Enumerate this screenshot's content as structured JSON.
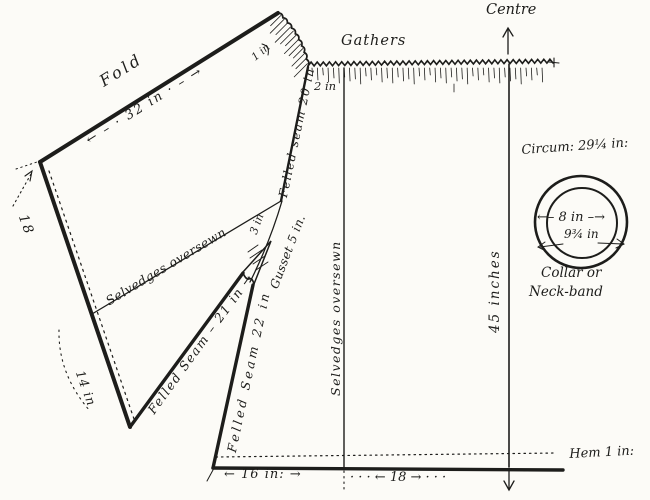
{
  "paper_color": "#fcfbf7",
  "ink_color": "#1d1d1b",
  "sleeve": {
    "fold_label": "Fold",
    "fold_dimension": "← – · 32 in · – →",
    "edge_upper_dimension": "18",
    "edge_lower_dimension": "14 in",
    "selvedge_label": "Selvedges oversewn",
    "seam_label": "Felled Seam – 21 in →",
    "ruffle_dimension": "1 in"
  },
  "body": {
    "gathers_label": "Gathers",
    "centre_label": "Centre",
    "shoulder_seam_label": "Felled seam 20 in",
    "gap_dimension": "2 in",
    "gusset_label": "Gusset 5 in.",
    "gusset_dimension": "3 in",
    "side_seam_label": "Felled Seam 22 in",
    "selvedge_label": "Selvedges oversewn",
    "length_dimension": "45 inches",
    "hem_label": "Hem 1 in:",
    "bottom_left_dimension": "← 16 in: →",
    "bottom_right_dimension": "· · · ← 18 → · · ·"
  },
  "collar": {
    "circumference_label": "Circum: 29¼ in:",
    "inner_diameter_dimension": "←– 8 in –→",
    "outer_diameter_dimension": "9¾ in",
    "caption_line_1": "Collar or",
    "caption_line_2": "Neck-band"
  }
}
